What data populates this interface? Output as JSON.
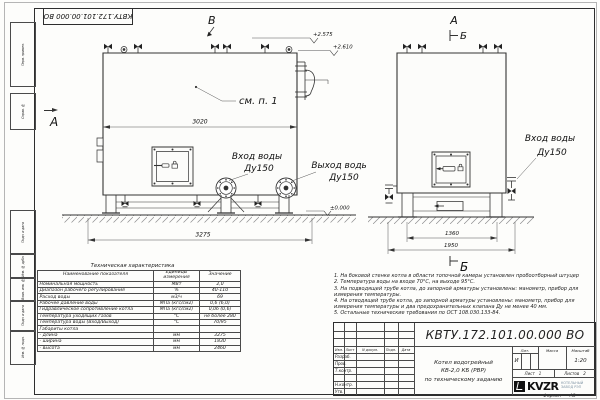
{
  "frame": {
    "stamp_top": "КВТУ.172.101.00.000 ВО",
    "left_labels": [
      "Перв. примен.",
      "Справ. №",
      "Подп. и дата",
      "Инв. № дубл.",
      "Взам. инв. №",
      "Подп. и дата",
      "Инв. № подл."
    ],
    "format_label": "Формат",
    "format_value": "А3"
  },
  "views": {
    "front": {
      "label_v": "В",
      "label_a": "А",
      "see_note": "см. п. 1",
      "dim_shell": "3020",
      "dim_total": "3275",
      "elev_top1": "+2.575",
      "elev_top2": "+2.610",
      "elev_zero": "±0.000",
      "inlet_line1": "Вход воды",
      "inlet_line2": "Ду150",
      "outlet_line1": "Выход воды",
      "outlet_line2": "Ду150"
    },
    "side": {
      "label_a": "А",
      "label_b": "Б",
      "dim_inner": "1360",
      "dim_outer": "1950",
      "inlet_line1": "Вход воды",
      "inlet_line2": "Ду150"
    }
  },
  "tech_table": {
    "title": "Техническая характеристика",
    "headers": [
      "Наименование показателя",
      "Единицы измерения",
      "Значение"
    ],
    "rows": [
      [
        "Номинальная мощность",
        "МВт",
        "2,0"
      ],
      [
        "Диапазон рабочего регулирования",
        "%",
        "40-110"
      ],
      [
        "Расход воды",
        "м3/ч",
        "69"
      ],
      [
        "Рабочее давление воды",
        "МПа (кгс/см2)",
        "0,6 (6,0)"
      ],
      [
        "Гидравлическое сопротивление котла",
        "МПа (кгс/см2)",
        "0,06 (0,6)"
      ],
      [
        "Температура уходящих газов",
        "°С",
        "не более 280"
      ],
      [
        "Температура воды (Вход/Выход)",
        "°С",
        "70/95"
      ],
      [
        "Габариты котла",
        "",
        ""
      ],
      [
        "    - длина",
        "мм",
        "3275"
      ],
      [
        "    - ширина",
        "мм",
        "1830"
      ],
      [
        "    - высота",
        "мм",
        "2460"
      ]
    ]
  },
  "notes": {
    "items": [
      "1.  На боковой стенке котла в области топочной камеры установлен пробоотборный штуцер",
      "2.  Температура воды на входе 70°С, на выходе 95°С.",
      "3.  На подводящей трубе котла, до запорной арматуры установлены: манометр, прибор для измерения температуры.",
      "4.  На отводящей трубе котла, до запорной арматуры установлены: манометр, прибор для измерения температуры и два предохранительных клапана Ду не менее 40 мм.",
      "5.  Остальные технические требования по ОСТ 108.030.133-84."
    ]
  },
  "title_block": {
    "doc_number": "КВТУ.172.101.00.000  ВО",
    "name_line1": "Котел водогрейный",
    "name_line2": "КВ-2,0 КБ (РВР)",
    "name_line3": "по техническому заданию",
    "col_izm": "Изм.",
    "col_list": "Лист",
    "col_doc": "N докум.",
    "col_podp": "Подп.",
    "col_data": "Дата",
    "row_razrab": "Разраб.",
    "row_prov": "Пров.",
    "row_tkontr": "Т.контр.",
    "row_nkontr": "Н.контр.",
    "row_utv": "Утв.",
    "lit_header": "Лит.",
    "lit_value": "И",
    "mass_header": "Масса",
    "scale_header": "Масштаб",
    "scale_value": "1:20",
    "sheet_label": "Лист",
    "sheet_value": "1",
    "sheets_label": "Листов",
    "sheets_value": "2",
    "logo_text": "KVZR",
    "logo_sub1": "КОТЕЛЬНЫЙ",
    "logo_sub2": "ЗАВОД РЭП"
  }
}
